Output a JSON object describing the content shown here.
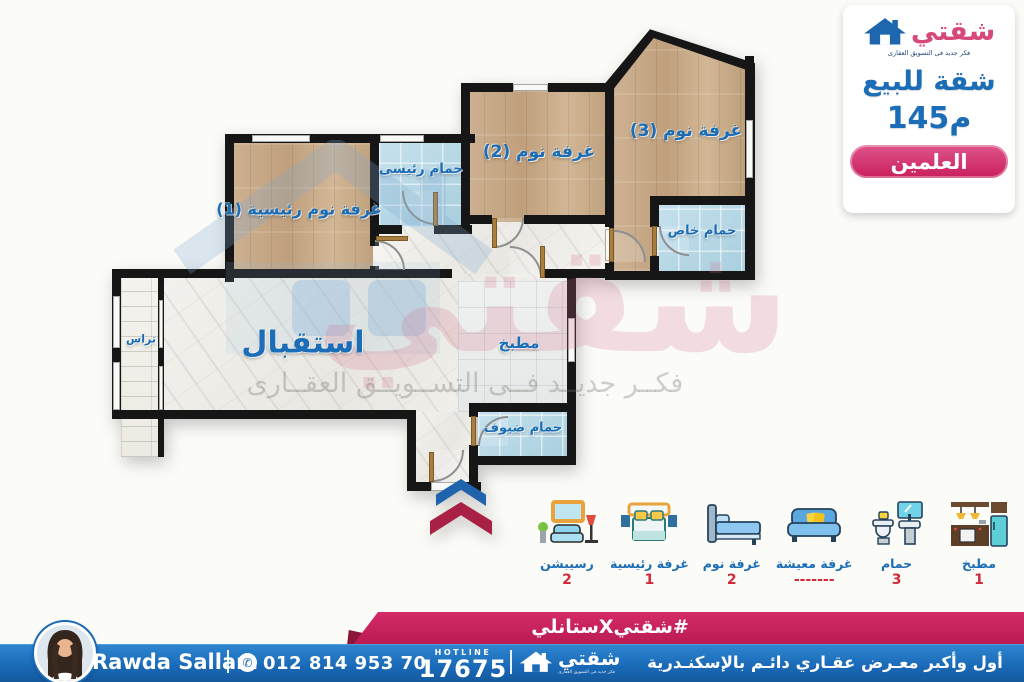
{
  "card": {
    "brand": "شقتي",
    "tagline": "فكر جديد فى التسويق العقارى",
    "sale_title": "شقة للبيع",
    "area": "145م",
    "location": "العلمين"
  },
  "plan": {
    "rooms": {
      "master_bedroom": "غرفة نوم رئيسية (1)",
      "master_bath": "حمام رئيسى",
      "bedroom2": "غرفة نوم (2)",
      "bedroom3": "غرفة نوم (3)",
      "private_bath": "حمام خاص",
      "reception": "استقبال",
      "kitchen": "مطبخ",
      "terrace": "تراس",
      "guest_bath": "حمام ضيوف"
    },
    "watermark_brand": "شقتي",
    "watermark_text": "فكــر جديــد فــى التســويــق العقــارى"
  },
  "legend": {
    "items": [
      {
        "icon": "reception-icon",
        "label": "رسيبشن",
        "count": "2"
      },
      {
        "icon": "master-bedroom-icon",
        "label": "غرفة رئيسية",
        "count": "1"
      },
      {
        "icon": "bedroom-icon",
        "label": "غرفة نوم",
        "count": "2"
      },
      {
        "icon": "living-room-icon",
        "label": "غرفة معيشة",
        "count": "-------"
      },
      {
        "icon": "bathroom-icon",
        "label": "حمام",
        "count": "3"
      },
      {
        "icon": "kitchen-icon",
        "label": "مطبخ",
        "count": "1"
      }
    ]
  },
  "footer": {
    "hashtag": "#شقتيXستانلي",
    "agent_name": "Rawda Sallam",
    "phone": "012 814 953 70",
    "hotline_label": "HOTLINE",
    "hotline_number": "17675",
    "brand": "شقتي",
    "brand_tagline": "فكر جديد فى التسويق العقارى",
    "slogan": "أول وأكبر معـرض عقـاري دائـم بالإسكنـدرية"
  },
  "colors": {
    "accent_blue": "#1a6db6",
    "brand_pink": "#d6487a",
    "ribbon_pink": "#c81e5c",
    "count_red": "#d2293b",
    "bar_blue": "#1a6ab8",
    "wall_black": "#161616"
  }
}
